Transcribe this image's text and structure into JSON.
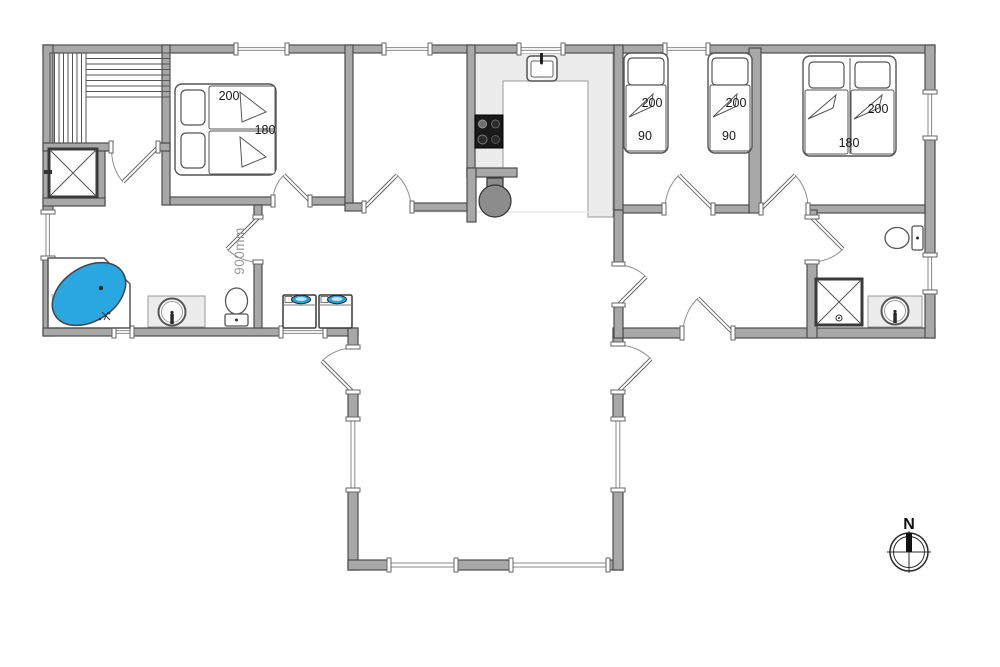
{
  "plan": {
    "type": "floor-plan",
    "compass_north": "N",
    "accessible_door_width_label": "900mm"
  },
  "rooms": {
    "bedroom_left": {
      "bed": {
        "length_cm": "200",
        "width_cm": "180"
      }
    },
    "bedroom_twin": {
      "bed_1": {
        "length_cm": "200",
        "width_cm": "90"
      },
      "bed_2": {
        "length_cm": "200",
        "width_cm": "90"
      }
    },
    "bedroom_double": {
      "bed": {
        "length_cm": "200",
        "width_cm": "180"
      }
    }
  },
  "fixtures": [
    "sauna-bench",
    "shower",
    "corner-bathtub",
    "washbasin",
    "toilet",
    "washing-machine",
    "washing-machine",
    "kitchen-sink",
    "cooktop",
    "wood-stove",
    "shower",
    "washbasin",
    "toilet",
    "compass-rose"
  ],
  "colors": {
    "wall_fill": "#a8a8a8",
    "wall_outline": "#4d4d4d",
    "counter_fill": "#ececec",
    "bathtub_blue": "#29a7e0",
    "washer_lid_blue": "#2d9fd6",
    "wood_stove_gray": "#8c8c8c",
    "cooktop_black": "#191919",
    "dimension_text": "#1a1a1a",
    "door_width_text": "#9b9b9b"
  }
}
